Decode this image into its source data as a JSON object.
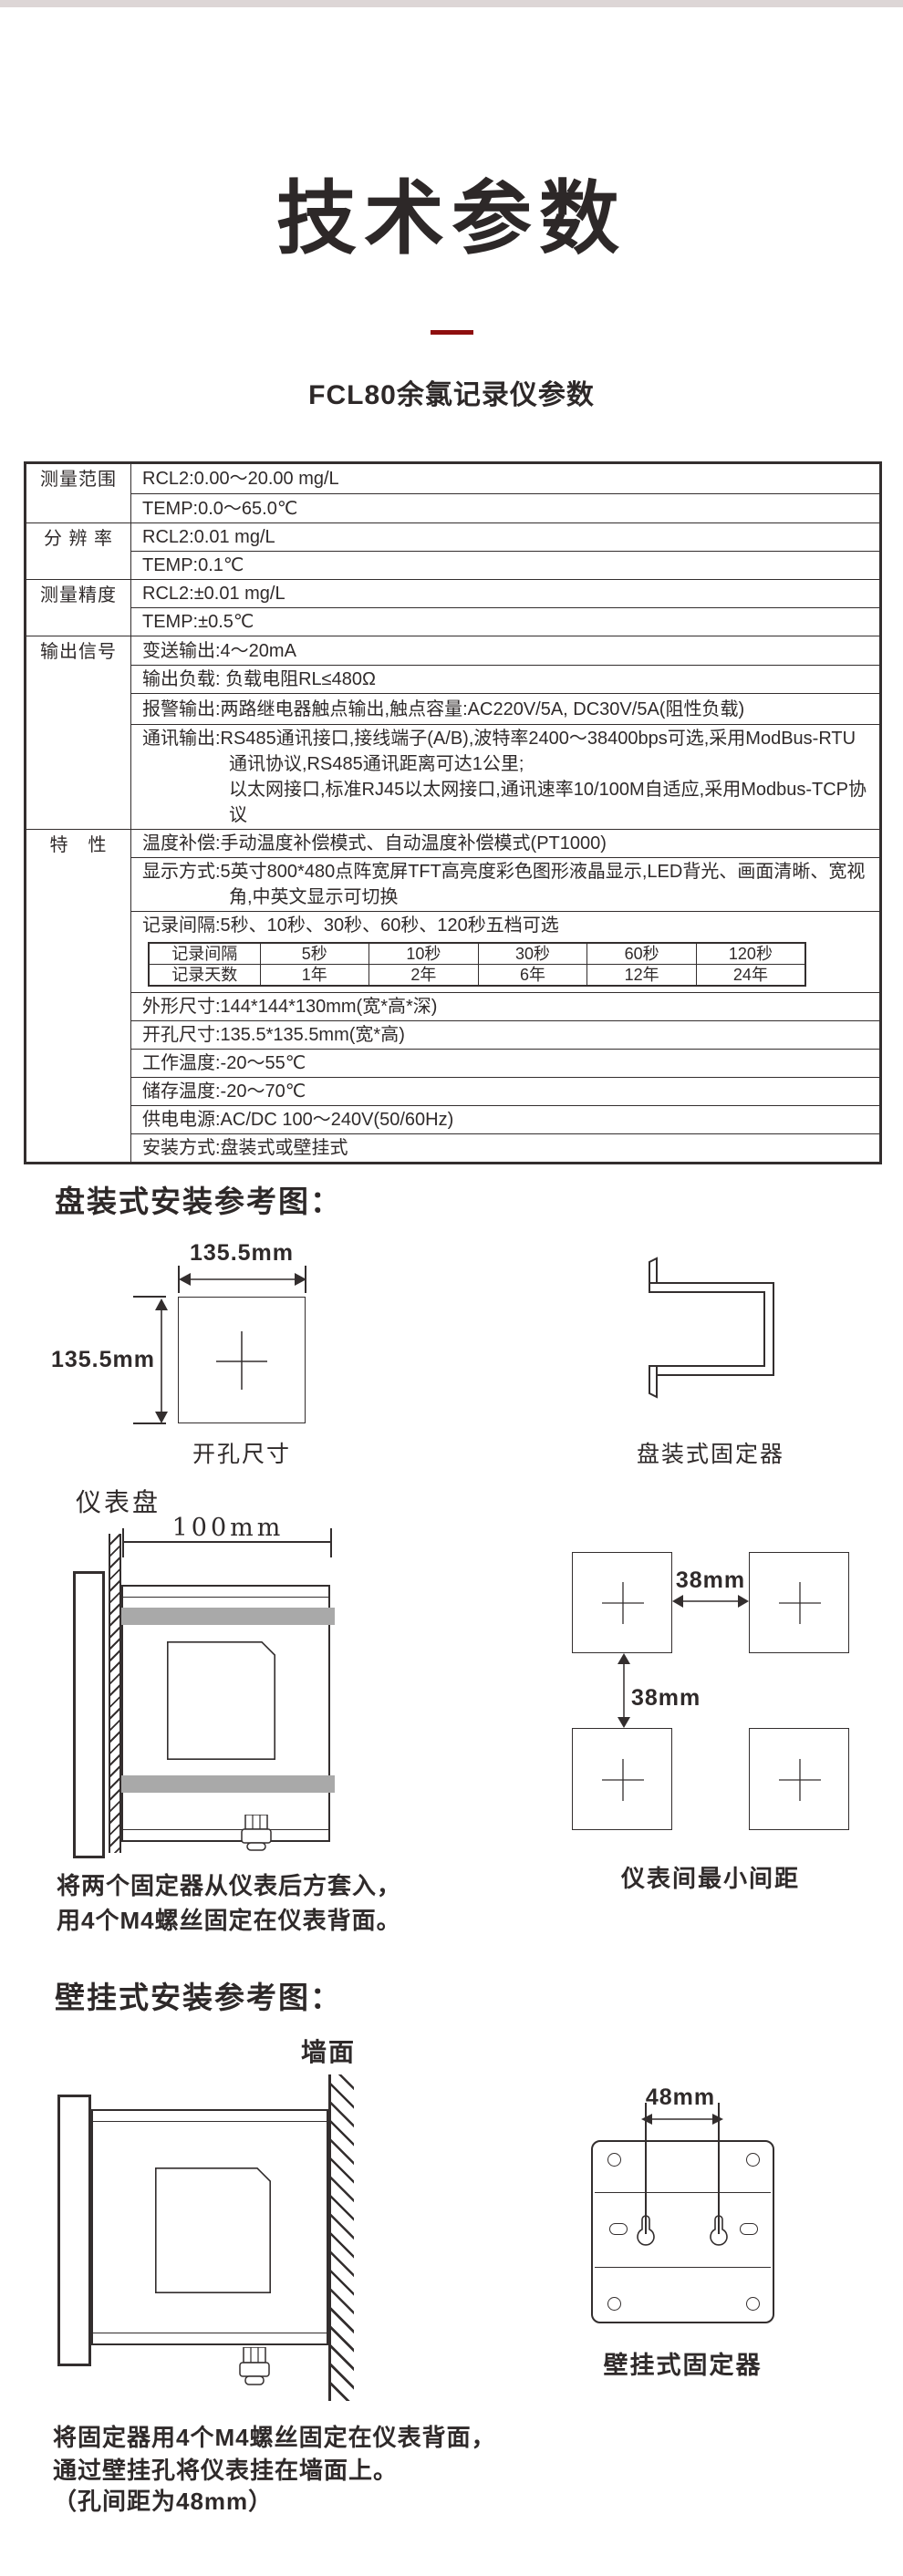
{
  "meta": {
    "top_strip_color": "#ddd6d6",
    "accent_color": "#8e0e0e",
    "ink_color": "#2f2a2a",
    "graybar_color": "#a9a9a9"
  },
  "header": {
    "title": "技术参数",
    "subtitle": "FCL80余氯记录仪参数"
  },
  "spec_table": {
    "labels": {
      "range": "测量范围",
      "resolution": "分 辨 率",
      "accuracy": "测量精度",
      "output": "输出信号",
      "features": "特　性"
    },
    "values": {
      "range_rcl2": "RCL2:0.00～20.00 mg/L",
      "range_temp": "TEMP:0.0～65.0℃",
      "res_rcl2": "RCL2:0.01 mg/L",
      "res_temp": "TEMP:0.1℃",
      "acc_rcl2": "RCL2:±0.01 mg/L",
      "acc_temp": "TEMP:±0.5℃",
      "transmit": "变送输出:4～20mA",
      "load": "输出负载: 负载电阻RL≤480Ω",
      "alarm": "报警输出:两路继电器触点输出,触点容量:AC220V/5A, DC30V/5A(阻性负载)",
      "comm_line1": "通讯输出:RS485通讯接口,接线端子(A/B),波特率2400～38400bps可选,采用ModBus-RTU",
      "comm_line2": "通讯协议,RS485通讯距离可达1公里;",
      "comm_line3": "以太网接口,标准RJ45以太网接口,通讯速率10/100M自适应,采用Modbus-TCP协议",
      "temp_comp": "温度补偿:手动温度补偿模式、自动温度补偿模式(PT1000)",
      "display_line1": "显示方式:5英寸800*480点阵宽屏TFT高亮度彩色图形液晶显示,LED背光、画面清晰、宽视",
      "display_line2": "角,中英文显示可切换",
      "record_interval": "记录间隔:5秒、10秒、30秒、60秒、120秒五档可选",
      "dimensions": "外形尺寸:144*144*130mm(宽*高*深)",
      "cutout": "开孔尺寸:135.5*135.5mm(宽*高)",
      "work_temp": "工作温度:-20～55℃",
      "storage_temp": "储存温度:-20～70℃",
      "power": "供电电源:AC/DC 100～240V(50/60Hz)",
      "mounting": "安装方式:盘装式或壁挂式"
    },
    "record_table": {
      "header": [
        "记录间隔",
        "5秒",
        "10秒",
        "30秒",
        "60秒",
        "120秒"
      ],
      "days": [
        "记录天数",
        "1年",
        "2年",
        "6年",
        "12年",
        "24年"
      ]
    }
  },
  "panel_section": {
    "heading": "盘装式安装参考图：",
    "cutout_width_label": "135.5mm",
    "cutout_height_label": "135.5mm",
    "cutout_caption": "开孔尺寸",
    "fixer_caption": "盘装式固定器",
    "panel_label": "仪表盘",
    "depth_label": "100mm",
    "h_spacing_label": "38mm",
    "v_spacing_label": "38mm",
    "spacing_caption": "仪表间最小间距",
    "note_line1": "将两个固定器从仪表后方套入，",
    "note_line2": "用4个M4螺丝固定在仪表背面。"
  },
  "wall_section": {
    "heading": "壁挂式安装参考图：",
    "wall_label": "墙面",
    "hole_spacing_label": "48mm",
    "fixer_caption": "壁挂式固定器",
    "note_line1": "将固定器用4个M4螺丝固定在仪表背面，",
    "note_line2": "通过壁挂孔将仪表挂在墙面上。",
    "note_line3": "（孔间距为48mm）"
  }
}
